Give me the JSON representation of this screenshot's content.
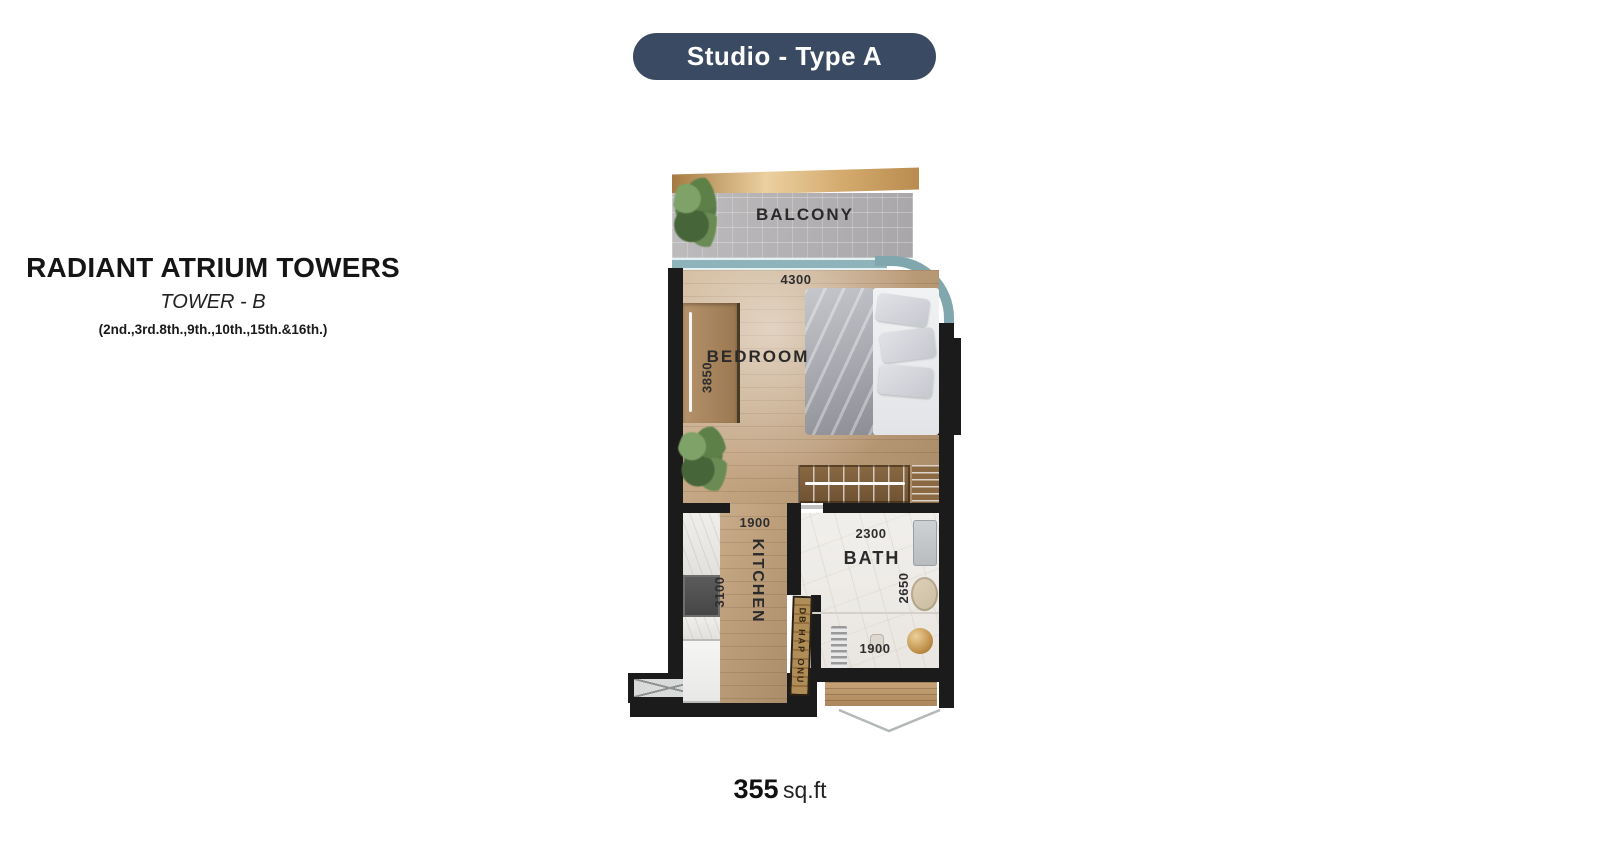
{
  "header": {
    "pill_label": "Studio - Type A"
  },
  "project": {
    "name": "RADIANT ATRIUM TOWERS",
    "tower": "TOWER - B",
    "floors_note": "(2nd.,3rd.8th.,9th.,10th.,15th.&16th.)"
  },
  "floorplan": {
    "rooms": {
      "balcony": "BALCONY",
      "bedroom": "BEDROOM",
      "kitchen": "KITCHEN",
      "bath": "BATH"
    },
    "dimensions": {
      "bedroom_width": "4300",
      "bedroom_depth": "3850",
      "kitchen_width": "1900",
      "kitchen_depth": "3100",
      "bath_width": "2300",
      "bath_depth": "2650",
      "bath_inner_width": "1900"
    },
    "door_label": "DB HAP ONU",
    "colors": {
      "accent_navy": "#3b4a63",
      "wall": "#1b1b1b",
      "wood_floor": "#bfa07f",
      "balcony_floor": "#b6b4b5",
      "glass": "#7fa7ad",
      "gold_trim": "#d4ab72",
      "bath_floor": "#eeece8"
    }
  },
  "area": {
    "value": "355",
    "unit": "sq.ft"
  }
}
